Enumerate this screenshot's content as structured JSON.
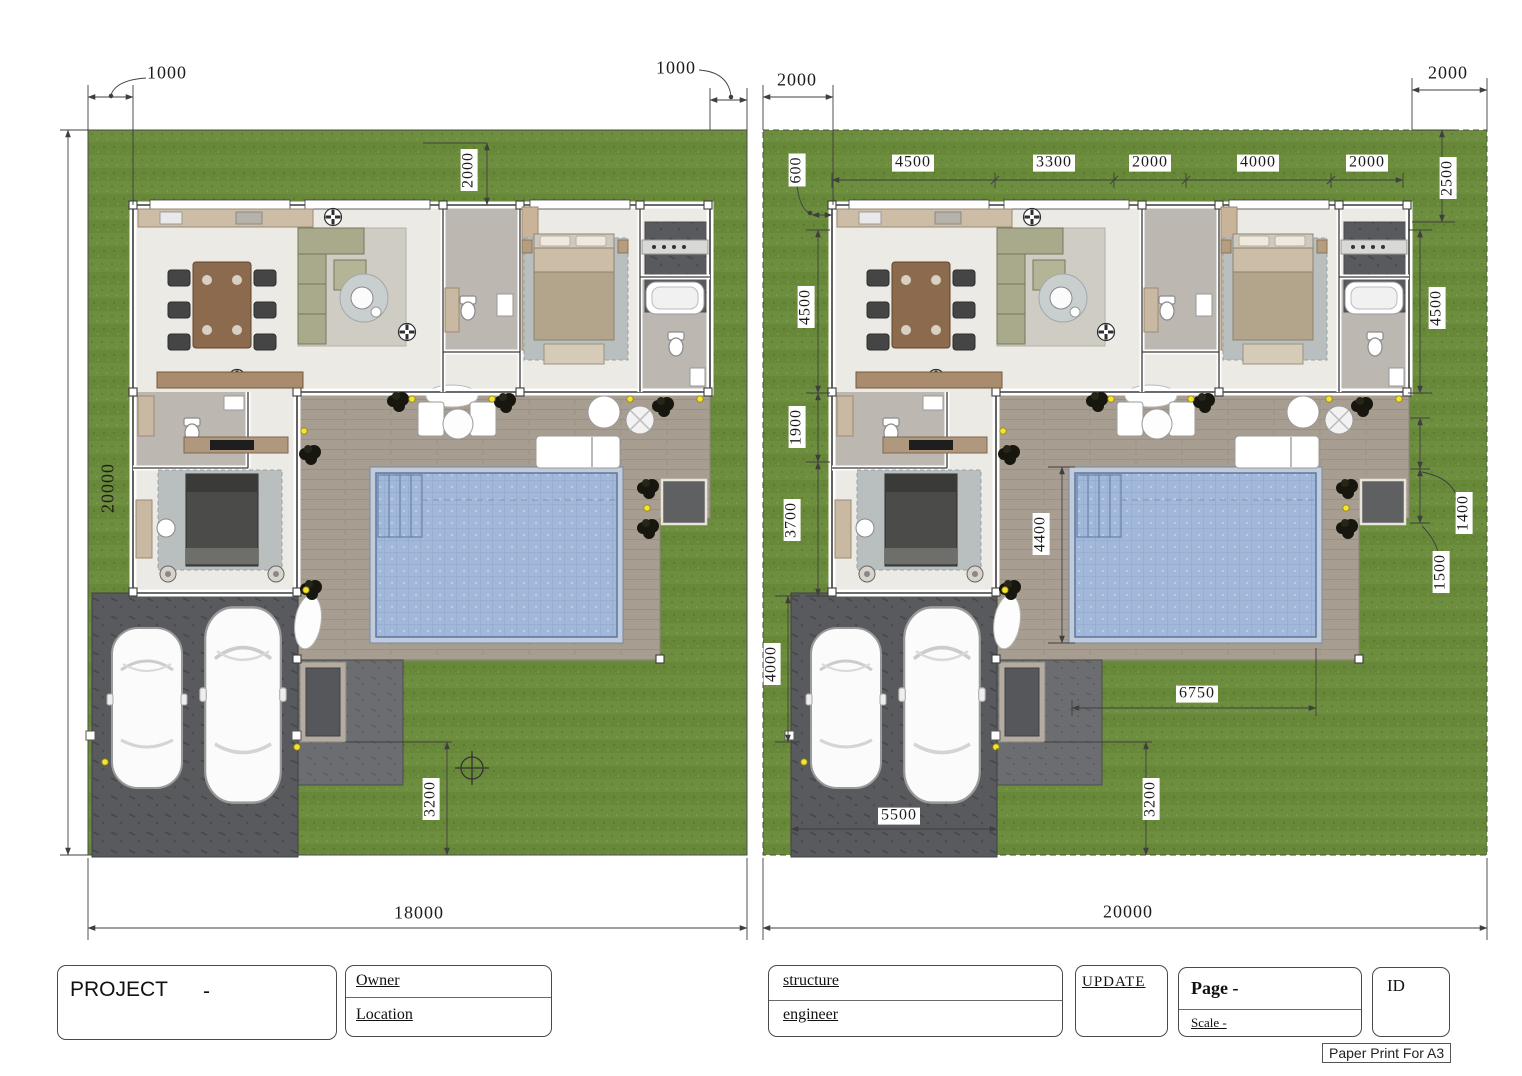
{
  "colors": {
    "grass": "#6d8d3f",
    "terrace": "#a79e91",
    "pool_water": "#a2b8da",
    "driveway": "#595a5d",
    "floor": "#eceae5",
    "bath_floor": "#bcb8b1",
    "deck_dark": "#5e6062",
    "dim_line": "#3f3f3f",
    "light_dot": "#f5e32d"
  },
  "left_plan": {
    "name": "site-plan-18000",
    "labels": [
      {
        "id": "offset-top-left",
        "text": "1000"
      },
      {
        "id": "offset-top-right",
        "text": "1000"
      },
      {
        "id": "front-setback",
        "text": "2000"
      },
      {
        "id": "site-depth",
        "text": "20000"
      },
      {
        "id": "rear-walk",
        "text": "3200"
      },
      {
        "id": "site-width",
        "text": "18000"
      }
    ]
  },
  "right_plan": {
    "name": "site-plan-20000",
    "labels": [
      {
        "id": "offset-top-left",
        "text": "2000"
      },
      {
        "id": "offset-top-right",
        "text": "2000"
      },
      {
        "id": "side-gap",
        "text": "600"
      },
      {
        "id": "bay-1",
        "text": "4500"
      },
      {
        "id": "bay-2",
        "text": "3300"
      },
      {
        "id": "bay-3",
        "text": "2000"
      },
      {
        "id": "bay-4",
        "text": "4000"
      },
      {
        "id": "bay-5",
        "text": "2000"
      },
      {
        "id": "corner-depth",
        "text": "2500"
      },
      {
        "id": "room-depth-left",
        "text": "4500"
      },
      {
        "id": "room-depth-right",
        "text": "4500"
      },
      {
        "id": "hall-depth",
        "text": "1900"
      },
      {
        "id": "bedroom-depth",
        "text": "3700"
      },
      {
        "id": "drive-depth",
        "text": "4000"
      },
      {
        "id": "pool-width",
        "text": "4400"
      },
      {
        "id": "pad-offset-1",
        "text": "1400"
      },
      {
        "id": "pad-offset-2",
        "text": "1500"
      },
      {
        "id": "pool-length",
        "text": "6750"
      },
      {
        "id": "drive-width",
        "text": "5500"
      },
      {
        "id": "rear-walk",
        "text": "3200"
      },
      {
        "id": "site-width",
        "text": "20000"
      }
    ]
  },
  "title_block": {
    "project_label": "PROJECT",
    "project_value": "-",
    "owner_label": "Owner",
    "location_label": "Location",
    "structure_label": "structure",
    "engineer_label": "engineer",
    "update_label": "UPDATE",
    "page_label": "Page -",
    "scale_label": "Scale -",
    "id_label": "ID",
    "paper_note": "Paper Print For A3"
  }
}
